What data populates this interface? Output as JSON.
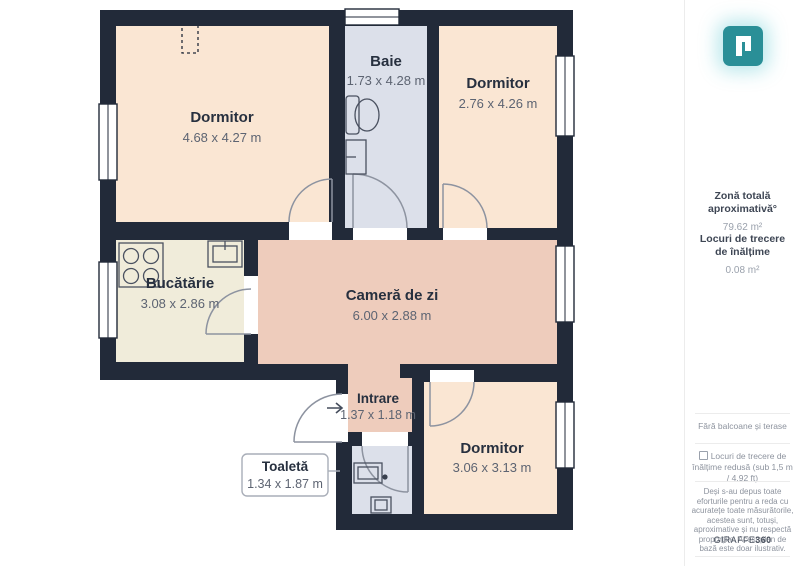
{
  "floor_plan": {
    "rooms": [
      {
        "name": "Dormitor",
        "dims": "4.68 x 4.27 m"
      },
      {
        "name": "Baie",
        "dims": "1.73 x 4.28 m"
      },
      {
        "name": "Dormitor",
        "dims": "2.76 x 4.26 m"
      },
      {
        "name": "Bucătărie",
        "dims": "3.08 x 2.86 m"
      },
      {
        "name": "Cameră de zi",
        "dims": "6.00 x 2.88 m"
      },
      {
        "name": "Intrare",
        "dims": "1.37 x 1.18 m"
      },
      {
        "name": "Toaletă",
        "dims": "1.34 x 1.87 m"
      },
      {
        "name": "Dormitor",
        "dims": "3.06 x 3.13 m"
      }
    ],
    "colors": {
      "wall": "#222a39",
      "bedroom_fill": "#fae6d3",
      "living_fill": "#eeccbc",
      "kitchen_fill": "#f0ecda",
      "wet_room_fill": "#dce0ea",
      "brand_teal": "#2a8f97"
    }
  },
  "sidebar": {
    "total_area_label": "Zonă totală aproximativă°",
    "total_area_value": "79.62 m²",
    "clearance_label": "Locuri de trecere de înălțime",
    "clearance_value": "0.08 m²",
    "no_balconies_note": "Fără balcoane și terase",
    "low_clearance_checkbox_label": "Locuri de trecere de înălțime redusă (sub 1,5 m / 4,92 ft)",
    "disclaimer": "Deși s-au depus toate eforturile pentru a reda cu acuratețe toate măsurătorile, acestea sunt, totuși, aproximative și nu respectă proporțiile. Acest plan de bază este doar ilustrativ.",
    "brand_name": "GIRAFFE",
    "brand_suffix": "360"
  }
}
